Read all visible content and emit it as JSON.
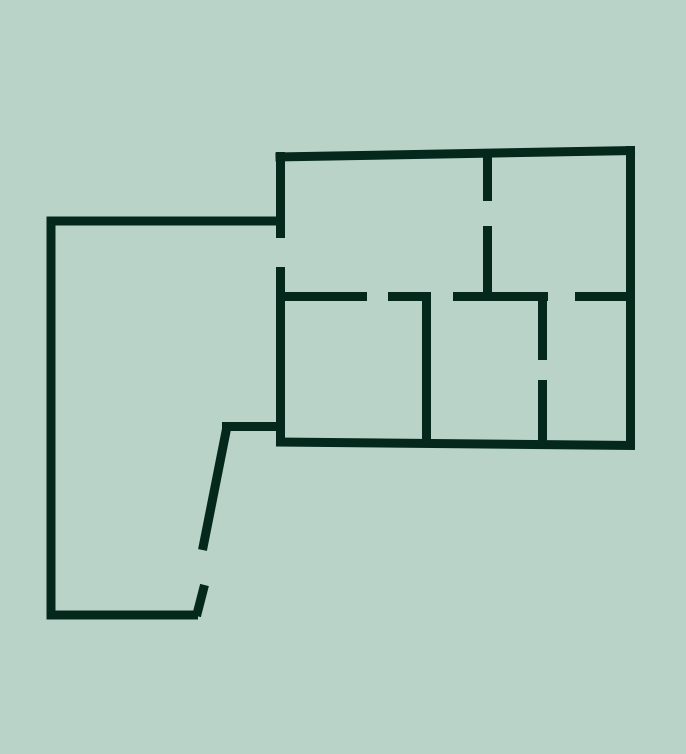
{
  "canvas": {
    "width": 686,
    "height": 754,
    "background_color": "#bad3c9",
    "wall_color": "#05281d",
    "wall_thickness": 9
  },
  "floorplan": {
    "kind": "floor-plan-line-drawing",
    "walls": [
      {
        "name": "left-room-top-wall",
        "x1": 46.5,
        "y1": 221,
        "x2": 285,
        "y2": 221
      },
      {
        "name": "left-room-left-wall",
        "x1": 51,
        "y1": 216.5,
        "x2": 51,
        "y2": 619.5
      },
      {
        "name": "left-room-bottom-wall",
        "x1": 46.5,
        "y1": 615,
        "x2": 198,
        "y2": 615
      },
      {
        "name": "left-room-door-leaf",
        "x1": 196.5,
        "y1": 616,
        "x2": 204.5,
        "y2": 585
      },
      {
        "name": "left-room-slanted-wall",
        "x1": 202.5,
        "y1": 550,
        "x2": 226.5,
        "y2": 429
      },
      {
        "name": "left-room-step-wall",
        "x1": 222,
        "y1": 426.5,
        "x2": 285,
        "y2": 426.5
      },
      {
        "name": "right-block-top-wall",
        "x1": 275.5,
        "y1": 157,
        "x2": 635,
        "y2": 150.5
      },
      {
        "name": "right-block-right-wall",
        "x1": 630.5,
        "y1": 146,
        "x2": 630.5,
        "y2": 448.5
      },
      {
        "name": "right-block-bottom-wall",
        "x1": 276,
        "y1": 442,
        "x2": 635,
        "y2": 445.5
      },
      {
        "name": "shared-wall-upper",
        "x1": 280.5,
        "y1": 152,
        "x2": 280.5,
        "y2": 238
      },
      {
        "name": "shared-wall-lower",
        "x1": 280.5,
        "y1": 267,
        "x2": 280.5,
        "y2": 445
      },
      {
        "name": "top-center-wall-upper",
        "x1": 487.5,
        "y1": 152,
        "x2": 487.5,
        "y2": 201
      },
      {
        "name": "top-center-wall-lower",
        "x1": 487.5,
        "y1": 226,
        "x2": 487.5,
        "y2": 298
      },
      {
        "name": "mid-wall-segment-1",
        "x1": 281,
        "y1": 296.5,
        "x2": 367,
        "y2": 296.5
      },
      {
        "name": "mid-wall-segment-2",
        "x1": 388,
        "y1": 296.5,
        "x2": 431,
        "y2": 296.5
      },
      {
        "name": "mid-wall-segment-3",
        "x1": 453,
        "y1": 296.5,
        "x2": 548,
        "y2": 296.5
      },
      {
        "name": "mid-wall-segment-4",
        "x1": 575,
        "y1": 296.5,
        "x2": 632,
        "y2": 296.5
      },
      {
        "name": "bottom-center-wall",
        "x1": 426.5,
        "y1": 292,
        "x2": 426.5,
        "y2": 445
      },
      {
        "name": "bottom-right-wall-upper",
        "x1": 542.5,
        "y1": 292,
        "x2": 542.5,
        "y2": 360
      },
      {
        "name": "bottom-right-wall-lower",
        "x1": 542.5,
        "y1": 380,
        "x2": 542.5,
        "y2": 445
      }
    ],
    "door_openings": [
      {
        "name": "door-shared-wall",
        "x": 280.5,
        "y1": 238,
        "y2": 267,
        "orientation": "vertical"
      },
      {
        "name": "door-top-center-wall",
        "x": 487.5,
        "y1": 201,
        "y2": 226,
        "orientation": "vertical"
      },
      {
        "name": "door-mid-wall-left",
        "y": 296.5,
        "x1": 367,
        "x2": 388,
        "orientation": "horizontal"
      },
      {
        "name": "door-mid-wall-center",
        "y": 296.5,
        "x1": 431,
        "x2": 453,
        "orientation": "horizontal"
      },
      {
        "name": "door-mid-wall-right",
        "y": 296.5,
        "x1": 548,
        "x2": 575,
        "orientation": "horizontal"
      },
      {
        "name": "door-bottom-right-wall",
        "x": 542.5,
        "y1": 360,
        "y2": 380,
        "orientation": "vertical"
      },
      {
        "name": "door-left-room-slant",
        "x1": 202.5,
        "y1": 550,
        "x2": 204.5,
        "y2": 585,
        "orientation": "slanted"
      }
    ]
  }
}
